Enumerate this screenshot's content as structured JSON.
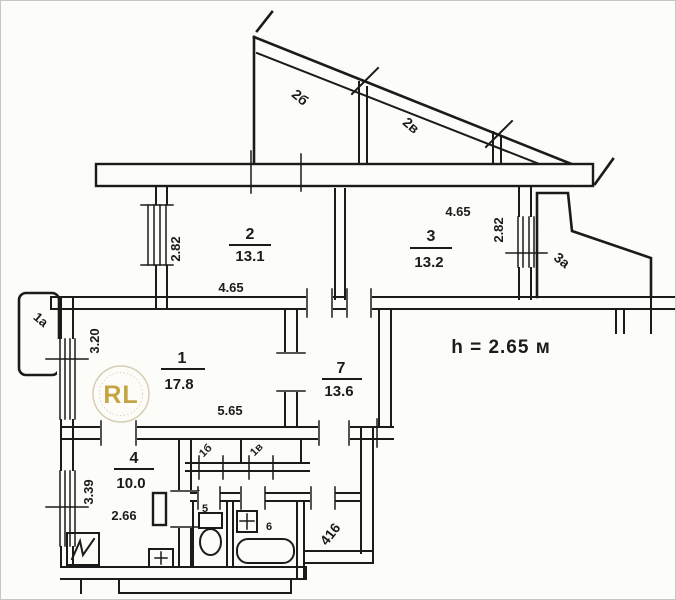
{
  "plan": {
    "height_note": "h = 2.65 м",
    "entrance_number": "416",
    "watermark_text": "RL",
    "rooms": {
      "r1": {
        "num": "1",
        "area": "17.8",
        "width": "5.65",
        "depth": "3.20"
      },
      "r2": {
        "num": "2",
        "area": "13.1",
        "width": "4.65",
        "depth": "2.82"
      },
      "r3": {
        "num": "3",
        "area": "13.2",
        "width": "4.65",
        "depth": "2.82"
      },
      "r4": {
        "num": "4",
        "area": "10.0",
        "width": "2.66",
        "depth": "3.39"
      },
      "r7": {
        "num": "7",
        "area": "13.6"
      },
      "wc": {
        "num": "5"
      },
      "bath": {
        "num": "6"
      }
    },
    "annexes": {
      "left_balcony": "1а",
      "top_terrace_a": "2б",
      "top_terrace_b": "2в",
      "right_balcony": "3а",
      "closet_a": "1б",
      "closet_b": "1в"
    }
  },
  "colors": {
    "ink": "#1b1b1b",
    "gold": "#bf9b30",
    "paper": "#fcfcf9"
  }
}
